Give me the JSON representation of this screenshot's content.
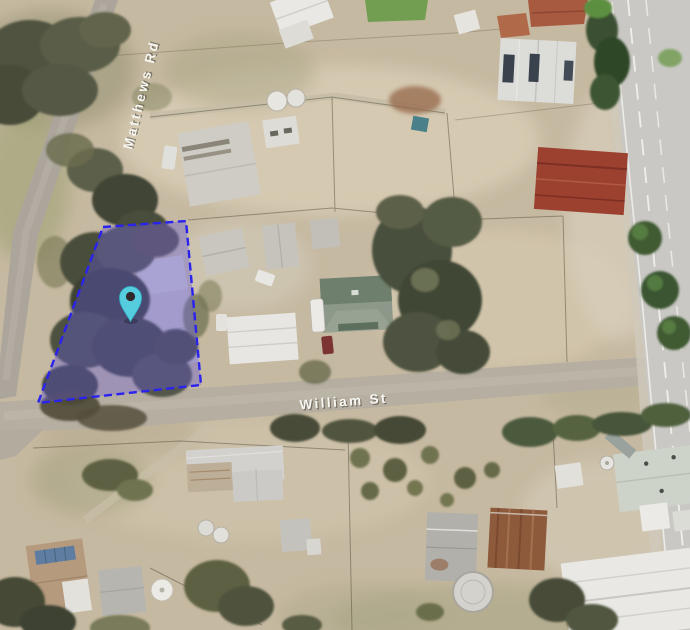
{
  "map": {
    "kind": "satellite-aerial-view",
    "streets": {
      "matthews": "Matthews Rd",
      "william": "William St"
    },
    "label_color": "#f7f6f1",
    "label_shadow_color": "#44423a",
    "parcel": {
      "fill_color": "rgba(97,86,215,0.38)",
      "border_color": "#2a22ef",
      "border_style": "dashed"
    },
    "pin": {
      "name": "location-pin",
      "color": "#55cddf",
      "rim_color": "#33b2c6",
      "hole_color": "#30282a"
    }
  }
}
